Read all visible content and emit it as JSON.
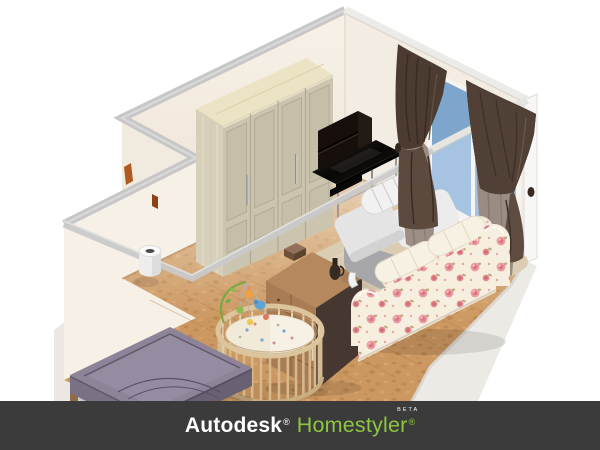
{
  "app": {
    "name": "Autodesk Homestyler",
    "view": "3d-isometric-room-preview"
  },
  "brand_bar": {
    "background": "#3b3b3b",
    "autodesk": "Autodesk",
    "autodesk_reg": "®",
    "autodesk_color": "#ffffff",
    "homestyler": "Homestyler",
    "homestyler_reg": "®",
    "homestyler_color": "#8dc63f",
    "beta": "BETA",
    "beta_color": "#ffffff"
  },
  "scene": {
    "type": "isometric-floorplan-render",
    "room": "L-shaped bedroom / nursery with cut-away front walls",
    "background": "#ffffff",
    "palette": {
      "wall": "#f5eee5",
      "wall_top_band": "#c7c7c7",
      "hidden_wall_band": "#c9c9c9",
      "floor_wood": "#cc9861",
      "outside_ground": "#ebe8e3",
      "rug": "#dacdb3",
      "wardrobe_front": "#cbc5af",
      "wardrobe_top": "#ebe3c4",
      "media_desk": "#15100d",
      "armchair": "#ececec",
      "sofa_fabric": "#f6efdf",
      "sofa_rose": "#e8959e",
      "curtain_dark": "#4c3b31",
      "curtain_light": "#9a8b83",
      "window_glass_upper": "#7ea6cd",
      "window_glass_lower": "#a6c3e1",
      "dresser_front": "#a97c54",
      "dresser_side": "#463831",
      "crib_wood": "#d9c097",
      "bed": "#8e8499",
      "door_edge": "#b05a22"
    },
    "objects": [
      {
        "name": "wardrobe",
        "label": "4-door wardrobe with silver handles"
      },
      {
        "name": "tv-desk",
        "label": "black media desk with hutch and metal legs"
      },
      {
        "name": "armchair",
        "label": "white fabric armchair with rolled cushion"
      },
      {
        "name": "sofa",
        "label": "cream sofa with rose floral slipcover"
      },
      {
        "name": "rug",
        "label": "beige area rug"
      },
      {
        "name": "dresser",
        "label": "brown chest of drawers with box and jug on top"
      },
      {
        "name": "crib",
        "label": "oval wooden baby crib with mattress"
      },
      {
        "name": "crib-mobile",
        "label": "colorful baby mobile toy"
      },
      {
        "name": "bed",
        "label": "purple double bed"
      },
      {
        "name": "wall-lamp",
        "label": "white cylindrical wall lamp"
      },
      {
        "name": "window",
        "label": "blue window with white frame and mullion"
      },
      {
        "name": "curtain-left",
        "label": "dark brown tied curtain with taupe inner panel"
      },
      {
        "name": "curtain-right",
        "label": "dark brown tied curtain with taupe inner panel"
      },
      {
        "name": "door-edge",
        "label": "open door edge in alcove"
      }
    ]
  }
}
